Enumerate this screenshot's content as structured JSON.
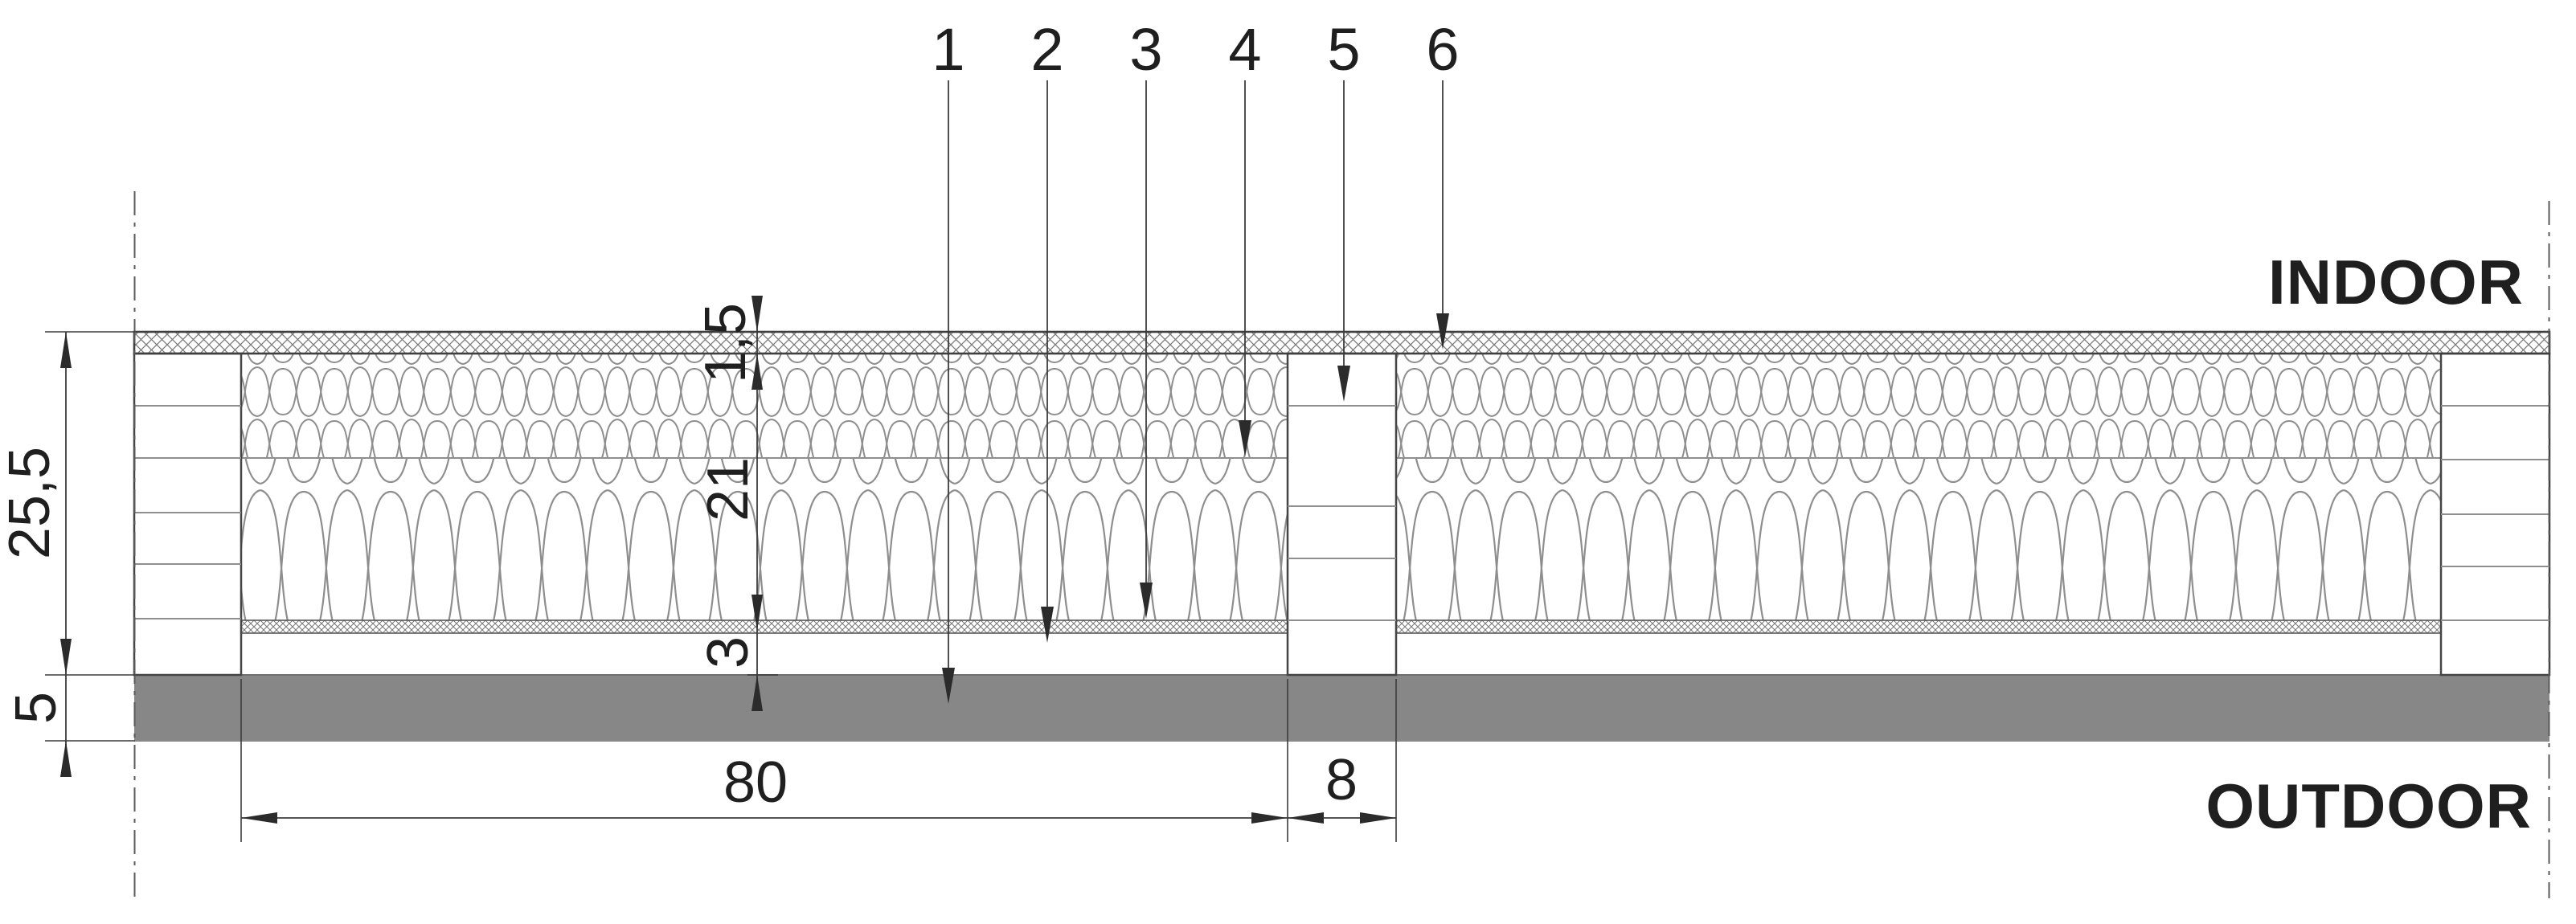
{
  "region_labels": {
    "indoor": "INDOOR",
    "outdoor": "OUTDOOR"
  },
  "callouts": [
    "1",
    "2",
    "3",
    "4",
    "5",
    "6"
  ],
  "dimensions": {
    "total_thickness": "25,5",
    "outer_render_layer": "5",
    "inner_lining": "1,5",
    "insulation": "21",
    "batten_gap": "3",
    "bay_width": "80",
    "stud_width": "8"
  },
  "colors": {
    "render_layer_gray": "#878787",
    "line_dark": "#3c3c3c",
    "hatch_gray": "#8e8e8e",
    "text": "#1f1f1f"
  }
}
